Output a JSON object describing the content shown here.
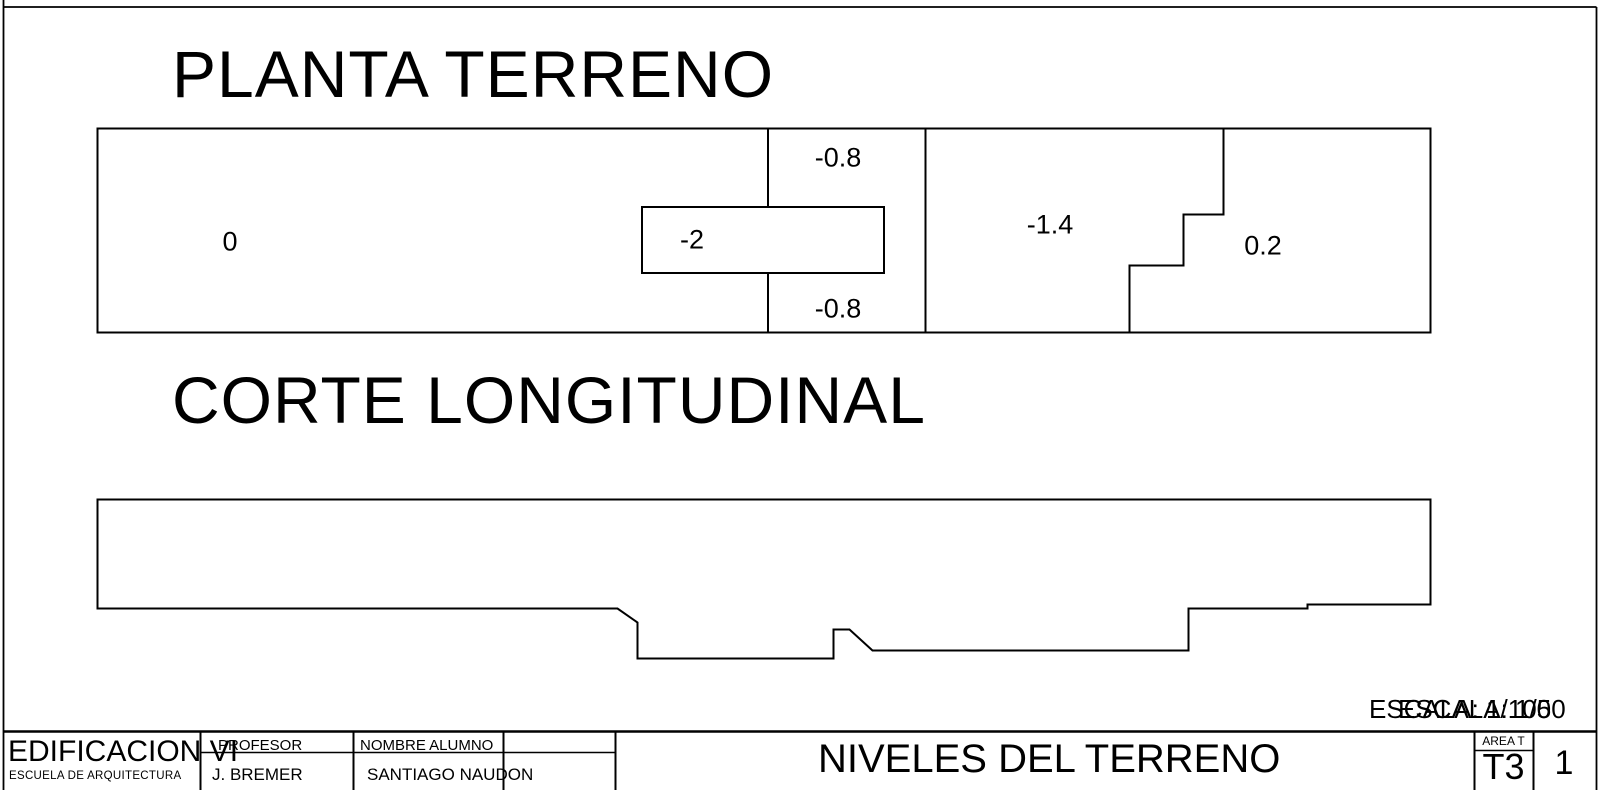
{
  "page": {
    "background_color": "#ffffff",
    "line_color": "#000000"
  },
  "plan": {
    "title": "PLANTA TERRENO",
    "levels": [
      {
        "name": "zone-0",
        "label": "0"
      },
      {
        "name": "zone-minus-0-8-top",
        "label": "-0.8"
      },
      {
        "name": "zone-minus-2",
        "label": "-2"
      },
      {
        "name": "zone-minus-0-8-bottom",
        "label": "-0.8"
      },
      {
        "name": "zone-minus-1-4",
        "label": "-1.4"
      },
      {
        "name": "zone-plus-0-2",
        "label": "0.2"
      }
    ]
  },
  "section": {
    "title": "CORTE LONGITUDINAL"
  },
  "scale_notes": {
    "plan_scale": "ESCALA: 1/100",
    "section_scale": "ESCALA: 1/50"
  },
  "title_block": {
    "project": "EDIFICACION VI",
    "school": "ESCUELA DE ARQUITECTURA",
    "professor_label": "PROFESOR",
    "professor": "J. BREMER",
    "student_label": "NOMBRE ALUMNO",
    "student": "SANTIAGO NAUDON",
    "sheet_title": "NIVELES DEL TERRENO",
    "area_label": "AREA T",
    "sheet_code": "T3",
    "sheet_number": "1"
  }
}
